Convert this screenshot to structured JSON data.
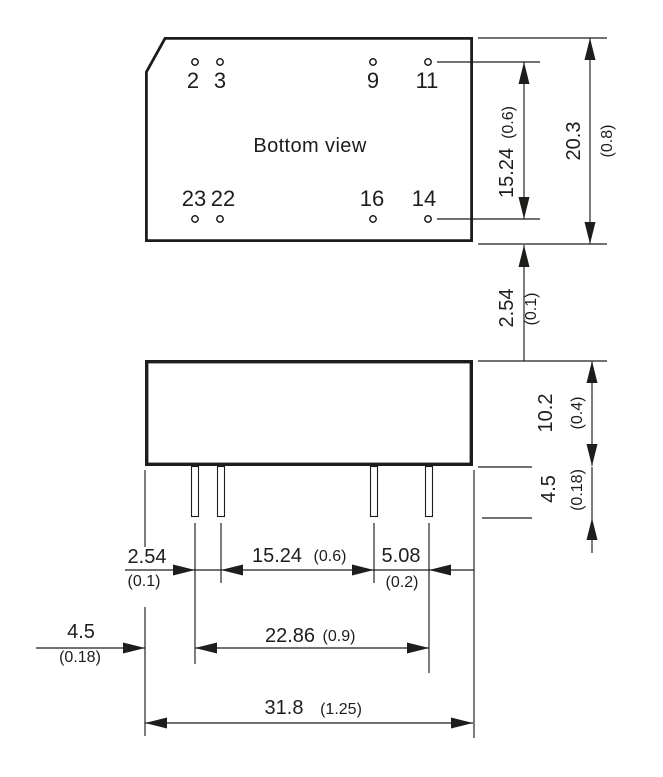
{
  "drawing": {
    "ink_color": "#1d1d1b",
    "background_color": "#ffffff"
  },
  "bottom_view": {
    "label": "Bottom view",
    "pin_labels_top": [
      "2",
      "3",
      "9",
      "11"
    ],
    "pin_labels_bottom": [
      "23",
      "22",
      "16",
      "14"
    ]
  },
  "dims": {
    "pin_rows": {
      "mm": "15.24",
      "inch": "(0.6)"
    },
    "depth": {
      "mm": "20.3",
      "inch": "(0.8)"
    },
    "row_edge": {
      "mm": "2.54",
      "inch": "(0.1)"
    },
    "height": {
      "mm": "10.2",
      "inch": "(0.4)"
    },
    "pin_len": {
      "mm": "4.5",
      "inch": "(0.18)"
    },
    "pitch": {
      "mm": "2.54",
      "inch": "(0.1)"
    },
    "span_mid": {
      "mm": "15.24",
      "inch": "(0.6)"
    },
    "gap_right": {
      "mm": "5.08",
      "inch": "(0.2)"
    },
    "edge": {
      "mm": "4.5",
      "inch": "(0.18)"
    },
    "pin_span": {
      "mm": "22.86",
      "inch": "(0.9)"
    },
    "width": {
      "mm": "31.8",
      "inch": "(1.25)"
    }
  }
}
